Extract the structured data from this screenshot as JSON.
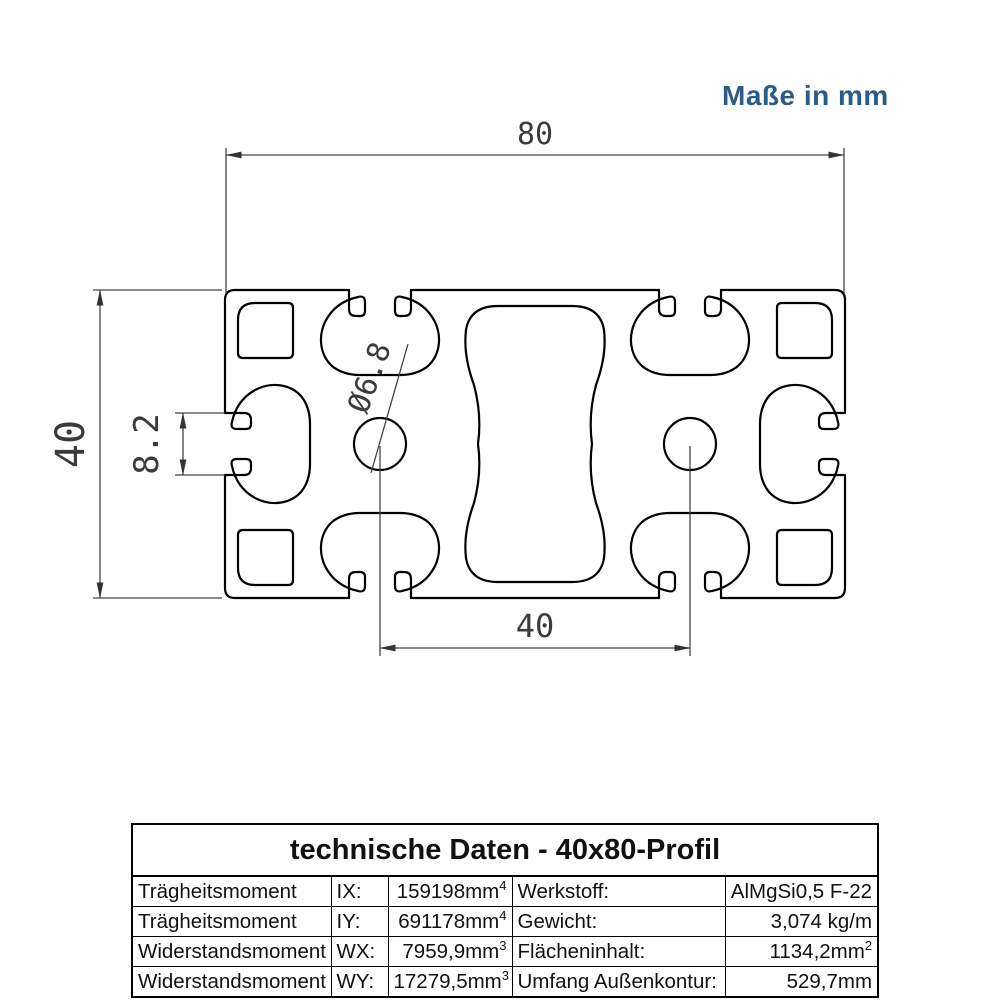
{
  "note": {
    "text": "Maße in mm",
    "color": "#2b5c87"
  },
  "drawing": {
    "dim_overall_width": "80",
    "dim_overall_height": "40",
    "dim_slot_width": "8.2",
    "dim_core_hole": "Ø6.8",
    "dim_hole_spacing": "40"
  },
  "table": {
    "title": "technische Daten - 40x80-Profil",
    "rows": [
      {
        "property": "Trägheitsmoment",
        "symbol": "IX:",
        "value": "159198mm",
        "value_sup": "4",
        "property2": "Werkstoff:",
        "value2": "AlMgSi0,5 F-22",
        "value2_sup": ""
      },
      {
        "property": "Trägheitsmoment",
        "symbol": "IY:",
        "value": "691178mm",
        "value_sup": "4",
        "property2": "Gewicht:",
        "value2": "3,074 kg/m",
        "value2_sup": ""
      },
      {
        "property": "Widerstandsmoment",
        "symbol": "WX:",
        "value": "7959,9mm",
        "value_sup": "3",
        "property2": "Flächeninhalt:",
        "value2": "1134,2mm",
        "value2_sup": "2"
      },
      {
        "property": "Widerstandsmoment",
        "symbol": "WY:",
        "value": "17279,5mm",
        "value_sup": "3",
        "property2": "Umfang Außenkontur:",
        "value2": "529,7mm",
        "value2_sup": ""
      }
    ]
  }
}
